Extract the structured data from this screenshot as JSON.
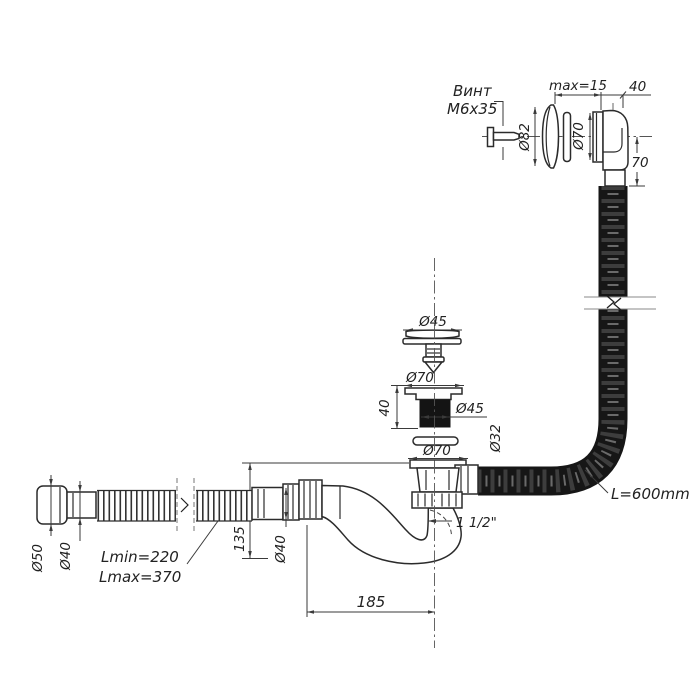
{
  "drawing": {
    "background": "#ffffff",
    "line_color": "#2b2b2b",
    "hose_color": "#161616",
    "overflow": {
      "screw_label_line1": "Винт",
      "screw_label_line2": "М6х35",
      "gap_dim": "max=15",
      "depth_dim": "40",
      "cover_diameter": "Ø82",
      "elbow_diameter": "Ø70",
      "outlet_height": "70",
      "hose_diameter": "Ø32",
      "hose_length": "L=600mm"
    },
    "drain": {
      "plug_diameter": "Ø45",
      "flange_diameter": "Ø70",
      "flange_height": "40",
      "body_diameter": "Ø45",
      "bottom_flange_diameter": "Ø70",
      "outlet_thread": "1 1/2\""
    },
    "trap": {
      "height": "135",
      "inlet_diameter": "Ø40",
      "offset_length": "185"
    },
    "outlet_pipe": {
      "cuff_diameter": "Ø50",
      "pipe_diameter": "Ø40",
      "length_min": "Lmin=220",
      "length_max": "Lmax=370"
    }
  }
}
